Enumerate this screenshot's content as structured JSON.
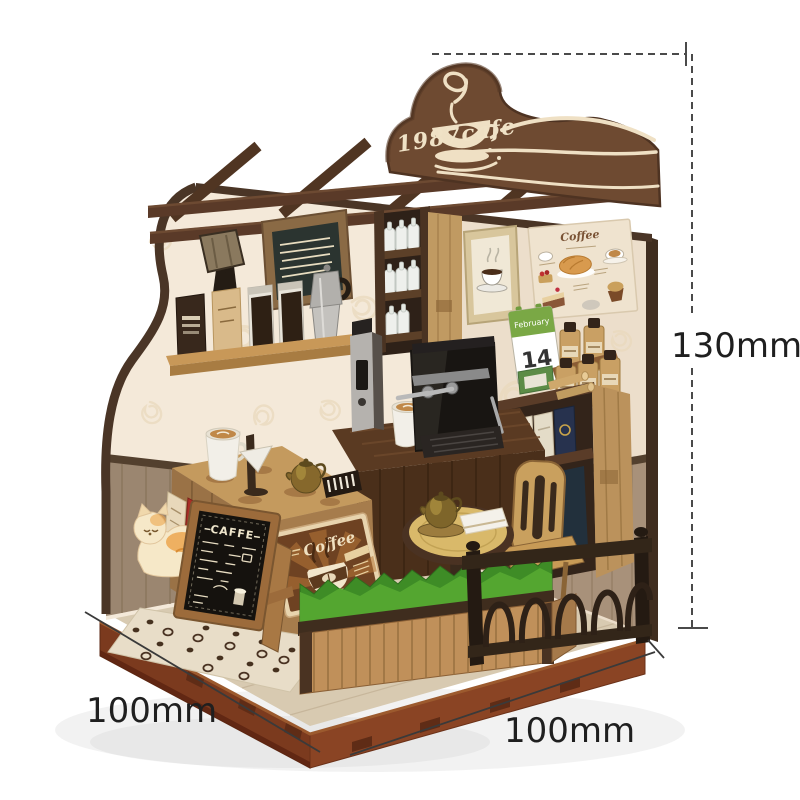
{
  "dimension_labels": {
    "height": "130mm",
    "base_width": "100mm",
    "base_depth": "100mm"
  },
  "signs": {
    "header": "1987cafe",
    "chalkboard_title": "CAFFE",
    "retro_poster_title": "Coffee",
    "dessert_menu_title": "Coffee",
    "vertical_banner": "COFFEE",
    "calendar_month": "February",
    "calendar_day": "14"
  },
  "palette": {
    "background": "#ffffff",
    "sign_wood": "#6e4a31",
    "sign_cream": "#f0e2c6",
    "wallpaper": "#f4e9d9",
    "wainscot": "#9b8670",
    "base_brown": "#7b3a1e",
    "counter_wood": "#a57a4a",
    "dark_walnut": "#503522",
    "grass_green": "#3e8c26",
    "banner_red": "#ab2f26",
    "calendar_green": "#7aa845",
    "dimension_line": "#3a3a3a"
  }
}
